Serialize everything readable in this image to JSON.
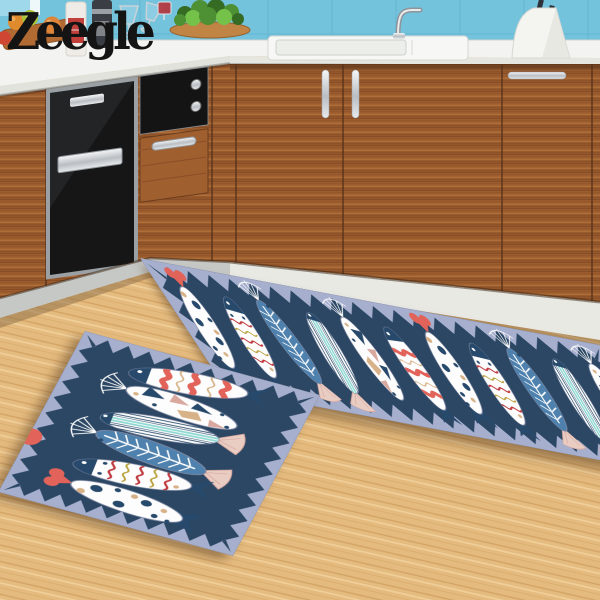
{
  "brand": {
    "logo_text": "Zeegle"
  },
  "palette": {
    "logo": "#141414",
    "backsplash": "#74c3dd",
    "backsplashLine": "#5fb1cf",
    "counter": "#f3f4f1",
    "counterEdge": "#e2e2da",
    "wood": "#9c5c2e",
    "seam": "#53301a",
    "applianceBlack": "#161616",
    "steel": "#c3c7ca",
    "steelDark": "#8e9499",
    "kickWhite": "#e9e9e4",
    "kickGray": "#c6c8c6",
    "floor": "#e4ba7e",
    "matBg": "#a6afce",
    "matNavy": "#2b4764",
    "fishWhite": "#fdfdfd",
    "fishOutline": "#7e88a3",
    "navy": "#27496b",
    "steelBlue": "#4e81ad",
    "mint": "#8ed8d2",
    "coral": "#e2635a",
    "red": "#bf3a3f",
    "mustard": "#b9a13c",
    "tan": "#d7b288",
    "pink": "#e9cdc3",
    "blush": "#d9a9a0",
    "green": "#4e9134",
    "greenDark": "#356b23",
    "greenLight": "#74c24a",
    "board": "#b06a32",
    "label": "#c2403c",
    "wine": "#b5373f"
  },
  "scene": {
    "objects": [
      "backsplash-tiles",
      "window",
      "countertop",
      "fruits",
      "cutting-board",
      "white-bottle",
      "pepper-grinder",
      "wine-glasses",
      "red-wine-glass",
      "herb-plant",
      "round-board",
      "sink",
      "faucet",
      "knife-block",
      "knives",
      "left-cabinets",
      "dishwasher",
      "oven",
      "oven-dials",
      "drawer",
      "right-cabinets",
      "door-handles",
      "kickboard",
      "wood-floor"
    ]
  },
  "mats": {
    "runner": {
      "w": 480,
      "h": 118,
      "zig": {
        "margin": 4,
        "tooth": 13,
        "step": 21
      },
      "fishScale": [
        0.88,
        0.92
      ],
      "fish": [
        {
          "v": "dots",
          "x": 26,
          "y": 58,
          "rot": 94
        },
        {
          "v": "zigzag",
          "x": 69,
          "y": 60,
          "rot": -84
        },
        {
          "v": "fishbone",
          "x": 112,
          "y": 57,
          "rot": -96
        },
        {
          "v": "stripes",
          "x": 155,
          "y": 60,
          "rot": -83
        },
        {
          "v": "geometric",
          "x": 198,
          "y": 58,
          "rot": 86
        },
        {
          "v": "bands",
          "x": 241,
          "y": 60,
          "rot": -93
        },
        {
          "v": "dots",
          "x": 284,
          "y": 57,
          "rot": 92
        },
        {
          "v": "zigzag",
          "x": 327,
          "y": 60,
          "rot": -87
        },
        {
          "v": "fishbone",
          "x": 370,
          "y": 58,
          "rot": -91
        },
        {
          "v": "stripes",
          "x": 413,
          "y": 60,
          "rot": -85
        },
        {
          "v": "geometric",
          "x": 456,
          "y": 58,
          "rot": 88
        }
      ]
    },
    "small": {
      "w": 250,
      "h": 230,
      "zig": {
        "margin": 4,
        "tooth": 14,
        "step": 22
      },
      "fishScale": [
        1.45,
        1.1
      ],
      "extraDot": {
        "x": 3,
        "y": 150,
        "r": 11,
        "color": "coral"
      },
      "fish": [
        {
          "v": "bands",
          "x": 122,
          "y": 30,
          "rot": -6,
          "flip": true
        },
        {
          "v": "geometric",
          "x": 128,
          "y": 63,
          "rot": 5
        },
        {
          "v": "stripes",
          "x": 118,
          "y": 96,
          "rot": -5,
          "flip": true
        },
        {
          "v": "fishbone",
          "x": 122,
          "y": 129,
          "rot": 6,
          "flip": true
        },
        {
          "v": "zigzag",
          "x": 116,
          "y": 163,
          "rot": -5,
          "flip": true
        },
        {
          "v": "dots",
          "x": 124,
          "y": 198,
          "rot": 4
        }
      ]
    }
  }
}
